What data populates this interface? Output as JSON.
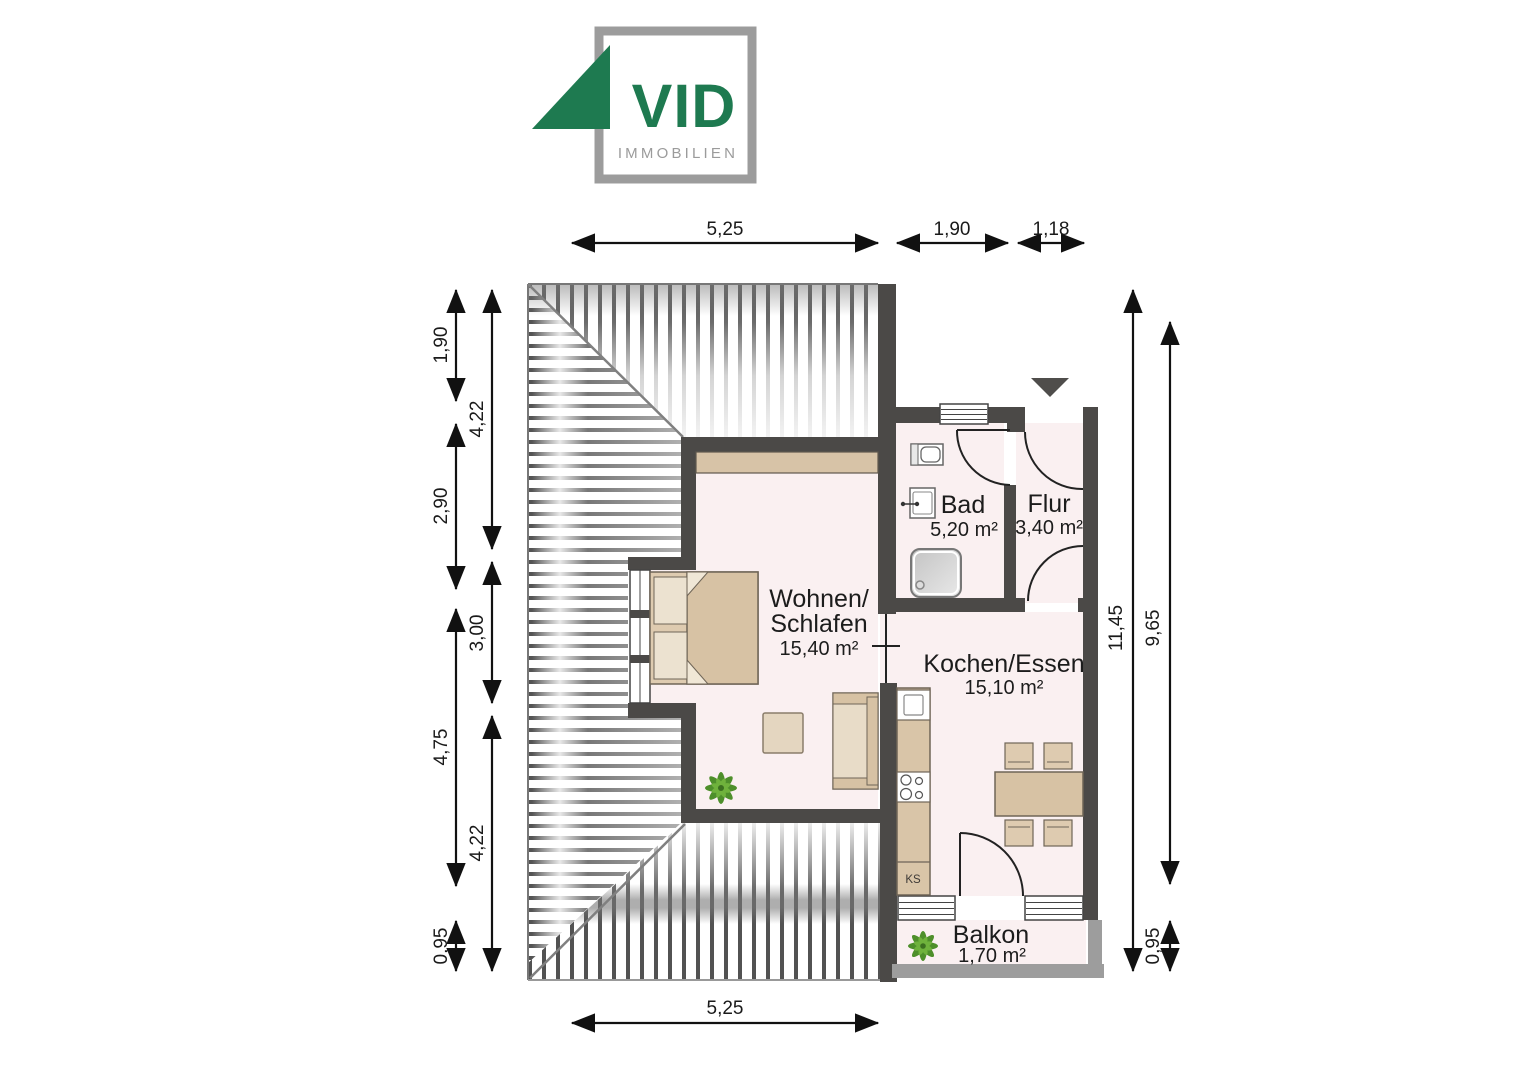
{
  "logo": {
    "brand": "VID",
    "subtitle": "IMMOBILIEN"
  },
  "rooms": {
    "wohnen": {
      "line1": "Wohnen/",
      "line2": "Schlafen",
      "area": "15,40 m²"
    },
    "kochen": {
      "name": "Kochen/Essen",
      "area": "15,10 m²"
    },
    "bad": {
      "name": "Bad",
      "area": "5,20 m²"
    },
    "flur": {
      "name": "Flur",
      "area": "3,40 m²"
    },
    "balkon": {
      "name": "Balkon",
      "area": "1,70 m²"
    }
  },
  "kitchen": {
    "fridge_label": "KS"
  },
  "dims": {
    "top": [
      "5,25",
      "1,90",
      "1,18"
    ],
    "left_outer": [
      "1,90",
      "2,90",
      "4,75",
      "0,95"
    ],
    "left_inner": [
      "4,22",
      "3,00",
      "4,22"
    ],
    "right_inner": [
      "11,45"
    ],
    "right_outer": [
      "9,65",
      "0,95"
    ],
    "bottom": [
      "5,25"
    ]
  },
  "colors": {
    "brand_green": "#1e7a50",
    "logo_gray": "#9c9c9c",
    "wall_dark": "#4b4947",
    "balcony_wall_gray": "#9d9d9d",
    "room_fill": "#faf0f1",
    "furniture_tan": "#d9c5a8",
    "dimension_text": "#1a1a1a"
  }
}
